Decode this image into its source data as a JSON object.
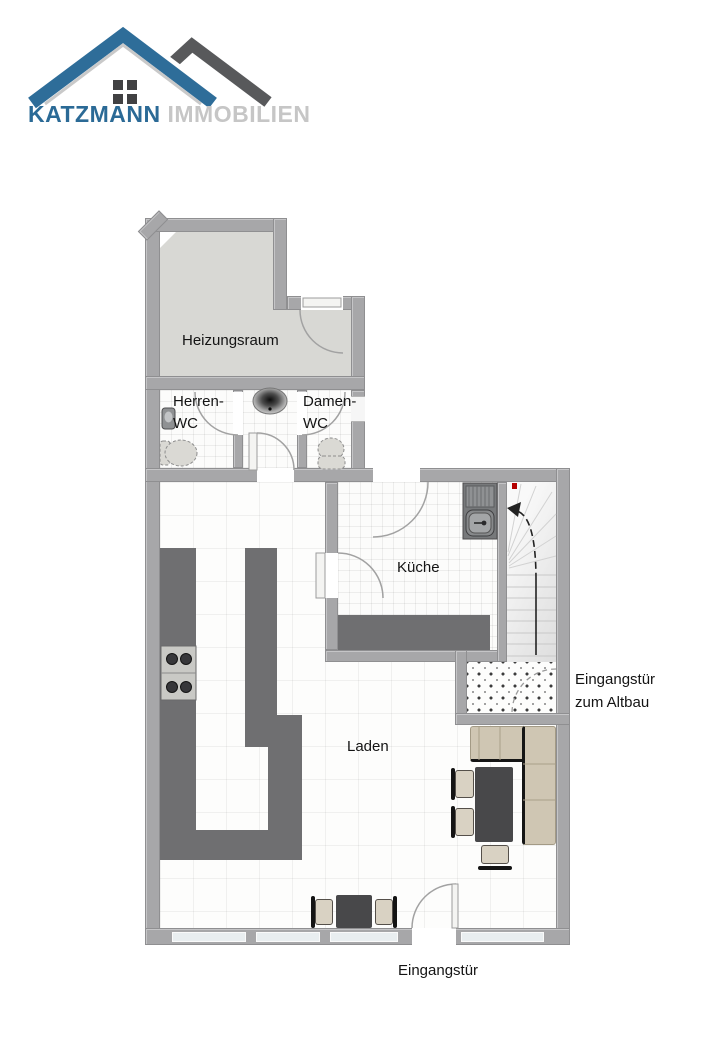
{
  "logo": {
    "brand": "KATZMANN",
    "suffix": "IMMOBILIEN",
    "colors": {
      "roof_blue": "#2e6d99",
      "roof_dark": "#58595b",
      "accent_silver": "#c9c9c9",
      "brand_text": "#2b6a96",
      "suffix_text": "#c6c6c6"
    }
  },
  "floor_plan": {
    "rooms": {
      "heizungsraum": {
        "label": "Heizungsraum"
      },
      "herren_wc": {
        "line1": "Herren-",
        "line2": "WC"
      },
      "damen_wc": {
        "line1": "Damen-",
        "line2": "WC"
      },
      "kueche": {
        "label": "Küche"
      },
      "laden": {
        "label": "Laden"
      }
    },
    "annotations": {
      "altbau_entrance": {
        "line1": "Eingangstür",
        "line2": "zum Altbau"
      },
      "main_entrance": {
        "label": "Eingangstür"
      }
    },
    "fixtures": [
      "stairs-up-arrow",
      "kitchen-sink",
      "stove",
      "washbasin",
      "toilet",
      "urinal",
      "door-swing-arcs",
      "sofa",
      "dining-table",
      "chairs",
      "windows",
      "red-marker"
    ],
    "colors": {
      "wall": "#a7a7a9",
      "heizungsraum_floor": "#d8d8d4",
      "counter_dark": "#6f6f71",
      "table_dark": "#48484a",
      "sofa_beige": "#cfc6b3",
      "window_glass": "#e9eef0",
      "marker_red": "#b40000"
    }
  }
}
